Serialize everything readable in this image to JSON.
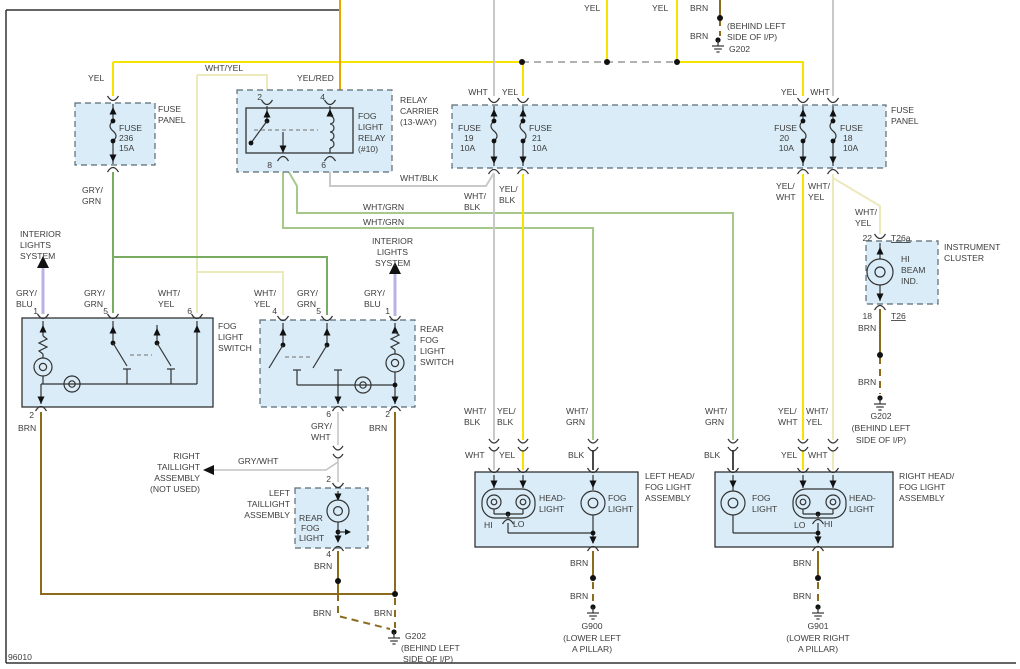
{
  "diagram": {
    "id": "96010",
    "type": "automotive-wiring-diagram",
    "system": "fog lights / rear fog light circuit"
  },
  "colors": {
    "wire_yellow": "#f6e300",
    "wire_pale_yellow": "#ece9bd",
    "wire_orange_yel_red": "#eaa400",
    "wire_white": "#c9c9c9",
    "wire_gray_white": "#c2c2c2",
    "wire_green_light": "#a6c98b",
    "wire_green_dark": "#79ab61",
    "wire_lavender": "#b9b4e4",
    "wire_brown": "#8a6c1c",
    "wire_black": "#4a4a4a",
    "component_fill": "#d9ecf7",
    "text": "#3d3d3d"
  },
  "labels": [
    {
      "n": "yel-feed-1",
      "t": "YEL",
      "x": 584,
      "y": 11
    },
    {
      "n": "yel-feed-2",
      "t": "YEL",
      "x": 652,
      "y": 11
    },
    {
      "n": "brn-feed",
      "t": "BRN",
      "x": 690,
      "y": 11
    },
    {
      "n": "brn-g202-top",
      "t": "BRN",
      "x": 690,
      "y": 39
    },
    {
      "n": "g202-top-loc-1",
      "t": "(BEHIND LEFT",
      "x": 727,
      "y": 29
    },
    {
      "n": "g202-top-loc-2",
      "t": "SIDE OF I/P)",
      "x": 727,
      "y": 40
    },
    {
      "n": "g202-top",
      "t": "G202",
      "x": 729,
      "y": 52
    },
    {
      "n": "yel-fuse236",
      "t": "YEL",
      "x": 88,
      "y": 81
    },
    {
      "n": "whtyel-top",
      "t": "WHT/YEL",
      "x": 205,
      "y": 71
    },
    {
      "n": "yelred-top",
      "t": "YEL/RED",
      "x": 297,
      "y": 81
    },
    {
      "n": "fuse236-1",
      "t": "FUSE",
      "x": 119,
      "y": 131
    },
    {
      "n": "fuse236-2",
      "t": "236",
      "x": 119,
      "y": 141
    },
    {
      "n": "fuse236-3",
      "t": "15A",
      "x": 119,
      "y": 151
    },
    {
      "n": "fuse-panel-left-1",
      "t": "FUSE",
      "x": 158,
      "y": 112
    },
    {
      "n": "fuse-panel-left-2",
      "t": "PANEL",
      "x": 158,
      "y": 123
    },
    {
      "n": "grygrn-fuse-1",
      "t": "GRY/",
      "x": 82,
      "y": 193
    },
    {
      "n": "grygrn-fuse-2",
      "t": "GRN",
      "x": 82,
      "y": 204
    },
    {
      "n": "relay-pin2",
      "t": "2",
      "x": 262,
      "y": 100,
      "a": "e"
    },
    {
      "n": "relay-pin4",
      "t": "4",
      "x": 325,
      "y": 100,
      "a": "e"
    },
    {
      "n": "relay-pin8",
      "t": "8",
      "x": 272,
      "y": 168,
      "a": "e"
    },
    {
      "n": "relay-pin6",
      "t": "6",
      "x": 326,
      "y": 168,
      "a": "e"
    },
    {
      "n": "relay-carrier-1",
      "t": "RELAY",
      "x": 400,
      "y": 103
    },
    {
      "n": "relay-carrier-2",
      "t": "CARRIER",
      "x": 400,
      "y": 114
    },
    {
      "n": "relay-carrier-3",
      "t": "(13-WAY)",
      "x": 400,
      "y": 125
    },
    {
      "n": "fog-relay-1",
      "t": "FOG",
      "x": 358,
      "y": 119
    },
    {
      "n": "fog-relay-2",
      "t": "LIGHT",
      "x": 358,
      "y": 130
    },
    {
      "n": "fog-relay-3",
      "t": "RELAY",
      "x": 358,
      "y": 141
    },
    {
      "n": "fog-relay-4",
      "t": "(#10)",
      "x": 358,
      "y": 152
    },
    {
      "n": "whtblk-relay",
      "t": "WHT/BLK",
      "x": 400,
      "y": 181
    },
    {
      "n": "wht-f19",
      "t": "WHT",
      "x": 478,
      "y": 95,
      "a": "m"
    },
    {
      "n": "yel-f21",
      "t": "YEL",
      "x": 510,
      "y": 95,
      "a": "m"
    },
    {
      "n": "fuse19-1",
      "t": "FUSE",
      "x": 458,
      "y": 131
    },
    {
      "n": "fuse19-2",
      "t": "19",
      "x": 464,
      "y": 141
    },
    {
      "n": "fuse19-3",
      "t": "10A",
      "x": 460,
      "y": 151
    },
    {
      "n": "fuse21-1",
      "t": "FUSE",
      "x": 529,
      "y": 131
    },
    {
      "n": "fuse21-2",
      "t": "21",
      "x": 532,
      "y": 141
    },
    {
      "n": "fuse21-3",
      "t": "10A",
      "x": 532,
      "y": 151
    },
    {
      "n": "yel-f20",
      "t": "YEL",
      "x": 789,
      "y": 95,
      "a": "m"
    },
    {
      "n": "wht-f18",
      "t": "WHT",
      "x": 820,
      "y": 95,
      "a": "m"
    },
    {
      "n": "fuse20-1",
      "t": "FUSE",
      "x": 797,
      "y": 131,
      "a": "e"
    },
    {
      "n": "fuse20-2",
      "t": "20",
      "x": 789,
      "y": 141,
      "a": "e"
    },
    {
      "n": "fuse20-3",
      "t": "10A",
      "x": 794,
      "y": 151,
      "a": "e"
    },
    {
      "n": "fuse18-1",
      "t": "FUSE",
      "x": 840,
      "y": 131
    },
    {
      "n": "fuse18-2",
      "t": "18",
      "x": 843,
      "y": 141
    },
    {
      "n": "fuse18-3",
      "t": "10A",
      "x": 843,
      "y": 151
    },
    {
      "n": "fuse-panel-right-1",
      "t": "FUSE",
      "x": 891,
      "y": 113
    },
    {
      "n": "fuse-panel-right-2",
      "t": "PANEL",
      "x": 891,
      "y": 124
    },
    {
      "n": "whtblk-down-1",
      "t": "WHT/",
      "x": 464,
      "y": 199
    },
    {
      "n": "whtblk-down-2",
      "t": "BLK",
      "x": 464,
      "y": 210
    },
    {
      "n": "yelblk-down-1",
      "t": "YEL/",
      "x": 499,
      "y": 192
    },
    {
      "n": "yelblk-down-2",
      "t": "BLK",
      "x": 499,
      "y": 203
    },
    {
      "n": "yelwht-down-1",
      "t": "YEL/",
      "x": 776,
      "y": 189
    },
    {
      "n": "yelwht-down-2",
      "t": "WHT",
      "x": 776,
      "y": 200
    },
    {
      "n": "whtyel-down-1",
      "t": "WHT/",
      "x": 808,
      "y": 189
    },
    {
      "n": "whtyel-down-2",
      "t": "YEL",
      "x": 808,
      "y": 200
    },
    {
      "n": "whtyel-cluster-1",
      "t": "WHT/",
      "x": 855,
      "y": 215
    },
    {
      "n": "whtyel-cluster-2",
      "t": "YEL",
      "x": 855,
      "y": 226
    },
    {
      "n": "whtgrn-h1",
      "t": "WHT/GRN",
      "x": 363,
      "y": 210
    },
    {
      "n": "whtgrn-h2",
      "t": "WHT/GRN",
      "x": 363,
      "y": 225
    },
    {
      "n": "ils-left-1",
      "t": "INTERIOR",
      "x": 20,
      "y": 237
    },
    {
      "n": "ils-left-2",
      "t": "LIGHTS",
      "x": 20,
      "y": 248
    },
    {
      "n": "ils-left-3",
      "t": "SYSTEM",
      "x": 20,
      "y": 259
    },
    {
      "n": "gryblu-l-1",
      "t": "GRY/",
      "x": 16,
      "y": 296
    },
    {
      "n": "gryblu-l-2",
      "t": "BLU",
      "x": 16,
      "y": 307
    },
    {
      "n": "fls-pin1",
      "t": "1",
      "x": 38,
      "y": 314,
      "a": "e"
    },
    {
      "n": "grygrn-l-1",
      "t": "GRY/",
      "x": 84,
      "y": 296
    },
    {
      "n": "grygrn-l-2",
      "t": "GRN",
      "x": 84,
      "y": 307
    },
    {
      "n": "fls-pin5",
      "t": "5",
      "x": 108,
      "y": 314,
      "a": "e"
    },
    {
      "n": "whtyel-l-1",
      "t": "WHT/",
      "x": 158,
      "y": 296
    },
    {
      "n": "whtyel-l-2",
      "t": "YEL",
      "x": 158,
      "y": 307
    },
    {
      "n": "fls-pin6",
      "t": "6",
      "x": 192,
      "y": 314,
      "a": "e"
    },
    {
      "n": "fog-light-switch-1",
      "t": "FOG",
      "x": 218,
      "y": 329
    },
    {
      "n": "fog-light-switch-2",
      "t": "LIGHT",
      "x": 218,
      "y": 340
    },
    {
      "n": "fog-light-switch-3",
      "t": "SWITCH",
      "x": 218,
      "y": 351
    },
    {
      "n": "fls-pin2",
      "t": "2",
      "x": 34,
      "y": 418,
      "a": "e"
    },
    {
      "n": "brn-fls",
      "t": "BRN",
      "x": 18,
      "y": 431
    },
    {
      "n": "whtyel-r4-1",
      "t": "WHT/",
      "x": 254,
      "y": 296
    },
    {
      "n": "whtyel-r4-2",
      "t": "YEL",
      "x": 254,
      "y": 307
    },
    {
      "n": "rfs-pin4",
      "t": "4",
      "x": 277,
      "y": 314,
      "a": "e"
    },
    {
      "n": "grygrn-r5-1",
      "t": "GRY/",
      "x": 297,
      "y": 296
    },
    {
      "n": "grygrn-r5-2",
      "t": "GRN",
      "x": 297,
      "y": 307
    },
    {
      "n": "rfs-pin5",
      "t": "5",
      "x": 321,
      "y": 314,
      "a": "e"
    },
    {
      "n": "gryblu-r-1",
      "t": "GRY/",
      "x": 364,
      "y": 296
    },
    {
      "n": "gryblu-r-2",
      "t": "BLU",
      "x": 364,
      "y": 307
    },
    {
      "n": "rfs-pin1",
      "t": "1",
      "x": 390,
      "y": 314,
      "a": "e"
    },
    {
      "n": "ils-right-1",
      "t": "INTERIOR",
      "x": 372,
      "y": 244
    },
    {
      "n": "ils-right-2",
      "t": "LIGHTS",
      "x": 377,
      "y": 255
    },
    {
      "n": "ils-right-3",
      "t": "SYSTEM",
      "x": 375,
      "y": 266
    },
    {
      "n": "rear-fog-switch-1",
      "t": "REAR",
      "x": 420,
      "y": 332
    },
    {
      "n": "rear-fog-switch-2",
      "t": "FOG",
      "x": 420,
      "y": 343
    },
    {
      "n": "rear-fog-switch-3",
      "t": "LIGHT",
      "x": 420,
      "y": 354
    },
    {
      "n": "rear-fog-switch-4",
      "t": "SWITCH",
      "x": 420,
      "y": 365
    },
    {
      "n": "rfs-pin6",
      "t": "6",
      "x": 331,
      "y": 417,
      "a": "e"
    },
    {
      "n": "grywht-v-1",
      "t": "GRY/",
      "x": 311,
      "y": 429
    },
    {
      "n": "grywht-v-2",
      "t": "WHT",
      "x": 311,
      "y": 440
    },
    {
      "n": "rfs-pin2",
      "t": "2",
      "x": 390,
      "y": 417,
      "a": "e"
    },
    {
      "n": "brn-rfs",
      "t": "BRN",
      "x": 369,
      "y": 431
    },
    {
      "n": "grywht-h",
      "t": "GRY/WHT",
      "x": 238,
      "y": 464
    },
    {
      "n": "right-taillight-1",
      "t": "RIGHT",
      "x": 200,
      "y": 459,
      "a": "e"
    },
    {
      "n": "right-taillight-2",
      "t": "TAILLIGHT",
      "x": 200,
      "y": 470,
      "a": "e"
    },
    {
      "n": "right-taillight-3",
      "t": "ASSEMBLY",
      "x": 200,
      "y": 481,
      "a": "e"
    },
    {
      "n": "right-taillight-4",
      "t": "(NOT USED)",
      "x": 200,
      "y": 492,
      "a": "e"
    },
    {
      "n": "tl-pin2",
      "t": "2",
      "x": 331,
      "y": 482,
      "a": "e"
    },
    {
      "n": "left-taillight-1",
      "t": "LEFT",
      "x": 290,
      "y": 496,
      "a": "e"
    },
    {
      "n": "left-taillight-2",
      "t": "TAILLIGHT",
      "x": 290,
      "y": 507,
      "a": "e"
    },
    {
      "n": "left-taillight-3",
      "t": "ASSEMBLY",
      "x": 290,
      "y": 518,
      "a": "e"
    },
    {
      "n": "rear-fog-light-1",
      "t": "REAR",
      "x": 299,
      "y": 521
    },
    {
      "n": "rear-fog-light-2",
      "t": "FOG",
      "x": 301,
      "y": 531
    },
    {
      "n": "rear-fog-light-3",
      "t": "LIGHT",
      "x": 299,
      "y": 541
    },
    {
      "n": "tl-pin4",
      "t": "4",
      "x": 331,
      "y": 557,
      "a": "e"
    },
    {
      "n": "brn-tl",
      "t": "BRN",
      "x": 314,
      "y": 569
    },
    {
      "n": "brn-bus-1",
      "t": "BRN",
      "x": 313,
      "y": 616
    },
    {
      "n": "brn-bus-2",
      "t": "BRN",
      "x": 374,
      "y": 616
    },
    {
      "n": "g202-bottom",
      "t": "G202",
      "x": 405,
      "y": 639
    },
    {
      "n": "g202-bottom-loc-1",
      "t": "(BEHIND LEFT",
      "x": 401,
      "y": 651
    },
    {
      "n": "g202-bottom-loc-2",
      "t": "SIDE OF I/P)",
      "x": 403,
      "y": 662
    },
    {
      "n": "whtblk-a-1",
      "t": "WHT/",
      "x": 464,
      "y": 414
    },
    {
      "n": "whtblk-a-2",
      "t": "BLK",
      "x": 464,
      "y": 425
    },
    {
      "n": "yelblk-a-1",
      "t": "YEL/",
      "x": 497,
      "y": 414
    },
    {
      "n": "yelblk-a-2",
      "t": "BLK",
      "x": 497,
      "y": 425
    },
    {
      "n": "whtgrn-a-1",
      "t": "WHT/",
      "x": 566,
      "y": 414
    },
    {
      "n": "whtgrn-a-2",
      "t": "GRN",
      "x": 566,
      "y": 425
    },
    {
      "n": "wht-a",
      "t": "WHT",
      "x": 465,
      "y": 458
    },
    {
      "n": "yel-a",
      "t": "YEL",
      "x": 499,
      "y": 458
    },
    {
      "n": "blk-a",
      "t": "BLK",
      "x": 568,
      "y": 458
    },
    {
      "n": "headlight-l-1",
      "t": "HEAD-",
      "x": 539,
      "y": 501
    },
    {
      "n": "headlight-l-2",
      "t": "LIGHT",
      "x": 539,
      "y": 512
    },
    {
      "n": "foglight-l-1",
      "t": "FOG",
      "x": 608,
      "y": 501
    },
    {
      "n": "foglight-l-2",
      "t": "LIGHT",
      "x": 608,
      "y": 512
    },
    {
      "n": "hi-left",
      "t": "HI",
      "x": 484,
      "y": 528
    },
    {
      "n": "lo-left",
      "t": "LO",
      "x": 513,
      "y": 527
    },
    {
      "n": "left-headfog-1",
      "t": "LEFT HEAD/",
      "x": 645,
      "y": 479
    },
    {
      "n": "left-headfog-2",
      "t": "FOG LIGHT",
      "x": 645,
      "y": 490
    },
    {
      "n": "left-headfog-3",
      "t": "ASSEMBLY",
      "x": 645,
      "y": 501
    },
    {
      "n": "brn-g900-a",
      "t": "BRN",
      "x": 570,
      "y": 566
    },
    {
      "n": "brn-g900-b",
      "t": "BRN",
      "x": 570,
      "y": 599
    },
    {
      "n": "g900",
      "t": "G900",
      "x": 592,
      "y": 629,
      "a": "m"
    },
    {
      "n": "g900-loc-1",
      "t": "(LOWER LEFT",
      "x": 592,
      "y": 641,
      "a": "m"
    },
    {
      "n": "g900-loc-2",
      "t": "A PILLAR)",
      "x": 592,
      "y": 652,
      "a": "m"
    },
    {
      "n": "whtgrn-b-1",
      "t": "WHT/",
      "x": 705,
      "y": 414
    },
    {
      "n": "whtgrn-b-2",
      "t": "GRN",
      "x": 705,
      "y": 425
    },
    {
      "n": "yelwht-a-1",
      "t": "YEL/",
      "x": 778,
      "y": 414
    },
    {
      "n": "yelwht-a-2",
      "t": "WHT",
      "x": 778,
      "y": 425
    },
    {
      "n": "whtyel-a-1",
      "t": "WHT/",
      "x": 806,
      "y": 414
    },
    {
      "n": "whtyel-a-2",
      "t": "YEL",
      "x": 806,
      "y": 425
    },
    {
      "n": "blk-b",
      "t": "BLK",
      "x": 704,
      "y": 458
    },
    {
      "n": "yel-b",
      "t": "YEL",
      "x": 781,
      "y": 458
    },
    {
      "n": "wht-b",
      "t": "WHT",
      "x": 808,
      "y": 458
    },
    {
      "n": "foglight-r-1",
      "t": "FOG",
      "x": 752,
      "y": 501
    },
    {
      "n": "foglight-r-2",
      "t": "LIGHT",
      "x": 752,
      "y": 512
    },
    {
      "n": "headlight-r-1",
      "t": "HEAD-",
      "x": 849,
      "y": 501
    },
    {
      "n": "headlight-r-2",
      "t": "LIGHT",
      "x": 849,
      "y": 512
    },
    {
      "n": "lo-right",
      "t": "LO",
      "x": 794,
      "y": 528
    },
    {
      "n": "hi-right",
      "t": "HI",
      "x": 824,
      "y": 527
    },
    {
      "n": "right-headfog-1",
      "t": "RIGHT HEAD/",
      "x": 899,
      "y": 479
    },
    {
      "n": "right-headfog-2",
      "t": "FOG LIGHT",
      "x": 899,
      "y": 490
    },
    {
      "n": "right-headfog-3",
      "t": "ASSEMBLY",
      "x": 899,
      "y": 501
    },
    {
      "n": "brn-g901-a",
      "t": "BRN",
      "x": 793,
      "y": 566
    },
    {
      "n": "brn-g901-b",
      "t": "BRN",
      "x": 793,
      "y": 599
    },
    {
      "n": "g901",
      "t": "G901",
      "x": 818,
      "y": 629,
      "a": "m"
    },
    {
      "n": "g901-loc-1",
      "t": "(LOWER RIGHT",
      "x": 818,
      "y": 641,
      "a": "m"
    },
    {
      "n": "g901-loc-2",
      "t": "A PILLAR)",
      "x": 818,
      "y": 652,
      "a": "m"
    },
    {
      "n": "ic-pin22",
      "t": "22",
      "x": 872,
      "y": 241,
      "a": "e"
    },
    {
      "n": "t26a",
      "t": "T26a",
      "x": 891,
      "y": 241,
      "u": true
    },
    {
      "n": "instrument-cluster-1",
      "t": "INSTRUMENT",
      "x": 944,
      "y": 250
    },
    {
      "n": "instrument-cluster-2",
      "t": "CLUSTER",
      "x": 944,
      "y": 261
    },
    {
      "n": "hi-beam-ind-1",
      "t": "HI",
      "x": 901,
      "y": 262
    },
    {
      "n": "hi-beam-ind-2",
      "t": "BEAM",
      "x": 901,
      "y": 273
    },
    {
      "n": "hi-beam-ind-3",
      "t": "IND.",
      "x": 901,
      "y": 284
    },
    {
      "n": "ic-pin18",
      "t": "18",
      "x": 872,
      "y": 319,
      "a": "e"
    },
    {
      "n": "t26",
      "t": "T26",
      "x": 891,
      "y": 319,
      "u": true
    },
    {
      "n": "brn-ic-1",
      "t": "BRN",
      "x": 858,
      "y": 331
    },
    {
      "n": "brn-ic-2",
      "t": "BRN",
      "x": 858,
      "y": 385
    },
    {
      "n": "g202-ic",
      "t": "G202",
      "x": 881,
      "y": 419,
      "a": "m"
    },
    {
      "n": "g202-ic-loc-1",
      "t": "(BEHIND LEFT",
      "x": 881,
      "y": 431,
      "a": "m"
    },
    {
      "n": "g202-ic-loc-2",
      "t": "SIDE OF I/P)",
      "x": 881,
      "y": 443,
      "a": "m"
    },
    {
      "n": "diagram-id",
      "t": "96010",
      "x": 8,
      "y": 660
    }
  ]
}
